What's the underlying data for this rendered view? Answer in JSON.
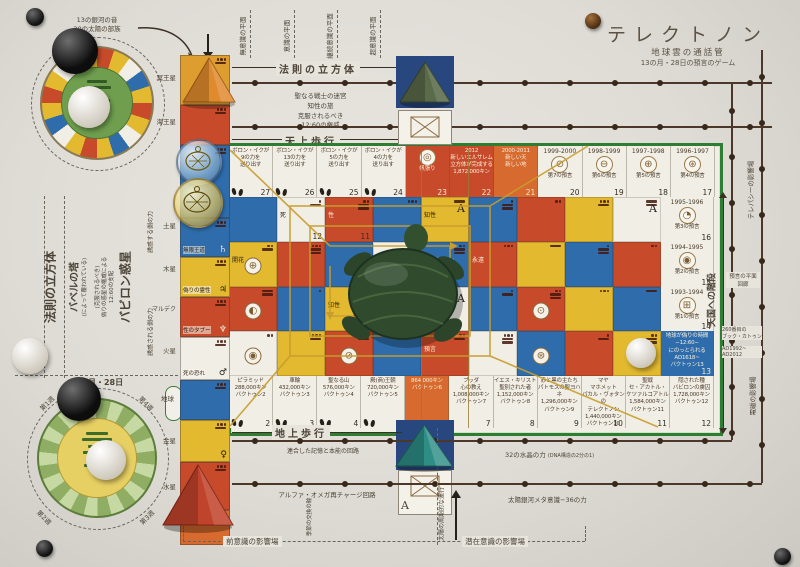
{
  "colors": {
    "red": "#c74b2a",
    "orange": "#d76a2e",
    "blue": "#2e6cab",
    "yellow": "#e2b92f",
    "white_cell": "#f1eee6",
    "green_border": "#2e7d32",
    "gold": "#c79d2e",
    "paper": "#e7e4dc",
    "circuit": "#4b382a"
  },
  "title": {
    "main": "テレクトノン",
    "sub1": "地球雲の通話管",
    "sub2": "13の月・28日の預言のゲーム"
  },
  "top_wheel": {
    "line1": "13の銀河の音",
    "line2": "20の太陽の部族"
  },
  "bottom_wheel": {
    "header": "13の月・28日",
    "weeks": [
      "第1週",
      "第2週",
      "第3週",
      "第4週"
    ]
  },
  "planet_labels": [
    "冥王星",
    "海王星",
    "土星",
    "木星",
    "マルデク",
    "火星",
    "地球",
    "金星",
    "水星"
  ],
  "left_labels": {
    "cube": "法則の立方体",
    "tower": "バベルの塔",
    "tower_sub": "(によって覆われている)",
    "rule_lines": [
      "(克服されるべき)",
      "偽りの惑星の権威による",
      "12:60の支配"
    ],
    "babylon": "バビロン惑星",
    "force_top": "誘惑する側の力",
    "force_bottom": "誘惑される側の力"
  },
  "top_labels": {
    "planes": [
      "無意識の平面",
      "意識の平面",
      "継続意識の平面",
      "超意識の平面"
    ],
    "cube": "法則の立方体",
    "warrior_lines": [
      "聖なる戦士の迷宮",
      "知性の旅",
      "克服されるべき",
      "12:60の権威"
    ],
    "heaven_walk": "天上歩行"
  },
  "right_labels": {
    "stairs": "天国への階段",
    "telepathy": "テレパシーの影響場",
    "corridor": [
      "預言の平面",
      "回廊"
    ],
    "katun": [
      "260番目の",
      "ブック・カトゥン"
    ],
    "years": [
      "AD1992~",
      "AD2012"
    ],
    "em": "電磁の影響場"
  },
  "bottom_labels": {
    "earth_walk": "地上歩行",
    "memory": "連合した記憶と本能の回路",
    "alpha": "アルファ・オメガ再チャージ回路",
    "crystal": "32の水晶の力",
    "crystal_sub": "(DNA構造の2分の1)",
    "meta": "太陽銀河メタ意識−36の力",
    "pre_field": "前意識の影響場",
    "sub_field": "潜在意識の影響場",
    "sun_motion": "太陽の周期的な運行",
    "season": "季節の交換の輪"
  },
  "board": {
    "top_row": [
      {
        "num": "27",
        "bg": "white",
        "lines": [
          "ボロン・イクが",
          "9の力を",
          "送り出す"
        ],
        "feet": true
      },
      {
        "num": "26",
        "bg": "white",
        "lines": [
          "ボロン・イクが",
          "13の力を",
          "送り出す"
        ],
        "feet": true
      },
      {
        "num": "25",
        "bg": "white",
        "lines": [
          "ボロン・イクが",
          "5の力を",
          "送り出す"
        ],
        "feet": true
      },
      {
        "num": "24",
        "bg": "white",
        "lines": [
          "ボロン・イクが",
          "4の力を",
          "送り出す"
        ],
        "feet": true
      },
      {
        "num": "23",
        "bg": "red",
        "lines": [
          "帆張り"
        ],
        "icon": "◎"
      },
      {
        "num": "22",
        "bg": "red",
        "lines": [
          "2012",
          "新しいエルサレム",
          "立方体が完成する",
          "1,872,000キン"
        ]
      },
      {
        "num": "21",
        "bg": "orange",
        "lines": [
          "2000-2011",
          "新しい天",
          "新しい地"
        ]
      },
      {
        "num": "20",
        "bg": "white",
        "year": "1999-2000",
        "icon": "⊘",
        "lines": [
          "第7の預言"
        ]
      },
      {
        "num": "19",
        "bg": "white",
        "year": "1998-1999",
        "icon": "⊖",
        "lines": [
          "第6の預言"
        ]
      },
      {
        "num": "18",
        "bg": "white",
        "year": "1997-1998",
        "icon": "⊕",
        "lines": [
          "第5の預言"
        ]
      },
      {
        "num": "17",
        "bg": "white",
        "year": "1996-1997",
        "icon": "⊛",
        "lines": [
          "第4の預言"
        ]
      }
    ],
    "right_col": [
      {
        "num": "16",
        "bg": "white",
        "year": "1995-1996",
        "icon": "◔",
        "lines": [
          "第3の預言"
        ]
      },
      {
        "num": "15",
        "bg": "white",
        "year": "1994-1995",
        "icon": "◉",
        "lines": [
          "第2の預言"
        ]
      },
      {
        "num": "14",
        "bg": "white",
        "year": "1993-1994",
        "icon": "⊞",
        "lines": [
          "第1の預言"
        ]
      },
      {
        "num": "13",
        "bg": "blue",
        "lines": [
          "地球が偽りの時間",
          "−12:60−",
          "にのっとられる",
          "AD1618~",
          "バクトゥン13"
        ]
      }
    ],
    "bottom_row": [
      {
        "num": "2",
        "bg": "white",
        "lines": [
          "ピラミッド",
          "288,000キン",
          "バクトゥン2"
        ],
        "feet": true
      },
      {
        "num": "3",
        "bg": "white",
        "lines": [
          "車輪",
          "432,000キン",
          "バクトゥン3"
        ],
        "feet": true
      },
      {
        "num": "4",
        "bg": "white",
        "lines": [
          "聖なる山",
          "576,000キン",
          "バクトゥン4"
        ],
        "feet": true
      },
      {
        "num": "5",
        "bg": "white",
        "lines": [
          "殿(商)王朝",
          "720,000キン",
          "バクトゥン5"
        ],
        "feet": true
      },
      {
        "num": "6",
        "bg": "orange",
        "lines": [
          "864,000キン",
          "バクトゥン6"
        ]
      },
      {
        "num": "7",
        "bg": "white",
        "lines": [
          "ブッダ",
          "心の教え",
          "1,008,000キン",
          "バクトゥン7"
        ]
      },
      {
        "num": "8",
        "bg": "white",
        "lines": [
          "イエス・キリスト",
          "聖別された者",
          "1,152,000キン",
          "バクトゥン8"
        ]
      },
      {
        "num": "9",
        "bg": "white",
        "lines": [
          "赤と黒の主たち",
          "パトモスの聖ヨハネ",
          "1,296,000キン",
          "バクトゥン9"
        ]
      },
      {
        "num": "10",
        "bg": "white",
        "lines": [
          "マヤ",
          "マホメット",
          "パカル・ヴォタンの",
          "テレクトノン",
          "1,440,000キン",
          "バクトゥン10"
        ]
      },
      {
        "num": "11",
        "bg": "white",
        "lines": [
          "聖戦",
          "セ・アカトル・",
          "ケツァルコアトル",
          "1,584,000キン",
          "バクトゥン11"
        ]
      },
      {
        "num": "12",
        "bg": "white",
        "lines": [
          "隠された種",
          "バビロンの虜囚",
          "1,728,000キン",
          "バクトゥン12"
        ]
      }
    ],
    "field": {
      "colors": [
        [
          "B",
          "W",
          "R",
          "B",
          "Y",
          "B",
          "R",
          "Y",
          "W"
        ],
        [
          "Y",
          "R",
          "B",
          "W",
          "B",
          "R",
          "Y",
          "B",
          "R"
        ],
        [
          "R",
          "B",
          "Y",
          "R",
          "W",
          "B",
          "R",
          "Y",
          "B"
        ],
        [
          "W",
          "Y",
          "R",
          "B",
          "R",
          "W",
          "B",
          "R",
          "Y"
        ]
      ],
      "labels": [
        {
          "r": 0,
          "c": 1,
          "t": "死",
          "n": "12"
        },
        {
          "r": 0,
          "c": 2,
          "t": "性",
          "n": "11"
        },
        {
          "r": 0,
          "c": 4,
          "t": "知性",
          "a": "A"
        },
        {
          "r": 0,
          "c": 8,
          "a": "A"
        },
        {
          "r": 1,
          "c": 0,
          "t": "開花"
        },
        {
          "r": 1,
          "c": 4,
          "t": "ヴィジョン"
        },
        {
          "r": 1,
          "c": 5,
          "t": "永遠"
        },
        {
          "r": 2,
          "c": 2,
          "t": "知性"
        },
        {
          "r": 2,
          "c": 4,
          "t": "永遠",
          "a": "A"
        },
        {
          "r": 3,
          "c": 4,
          "t": "預言"
        }
      ],
      "badges": [
        {
          "r": 1,
          "c": 0,
          "s": "⊕"
        },
        {
          "r": 2,
          "c": 0,
          "s": "◐"
        },
        {
          "r": 3,
          "c": 0,
          "s": "◉"
        },
        {
          "r": 3,
          "c": 2,
          "s": "⊘"
        },
        {
          "r": 2,
          "c": 6,
          "s": "⊙"
        },
        {
          "r": 3,
          "c": 6,
          "s": "⊛"
        }
      ]
    },
    "tower_top": [
      {
        "h": 50,
        "bg": "#dd9e2f"
      },
      {
        "h": 40,
        "bg": "#c74b2a"
      },
      {
        "h": 73,
        "bg": "#2e6cab"
      },
      {
        "h": 39,
        "bg": "#2e6cab",
        "label": "無限王道",
        "glyph": "♄"
      },
      {
        "h": 40,
        "bg": "#e2b92f",
        "label": "偽りの霊性",
        "glyph": "♃"
      },
      {
        "h": 40,
        "bg": "#c74b2a",
        "label": "性のタブー",
        "glyph": "♆"
      },
      {
        "h": 43,
        "bg": "#f1eee6",
        "label": "死の恐れ",
        "glyph": "♂"
      }
    ],
    "tower_bottom": [
      {
        "h": 40,
        "bg": "#2e6cab"
      },
      {
        "h": 42,
        "bg": "#e2b92f",
        "glyph": "♀"
      },
      {
        "h": 48,
        "bg": "#c74b2a"
      },
      {
        "h": 35,
        "bg": "#d76a2e"
      }
    ]
  }
}
